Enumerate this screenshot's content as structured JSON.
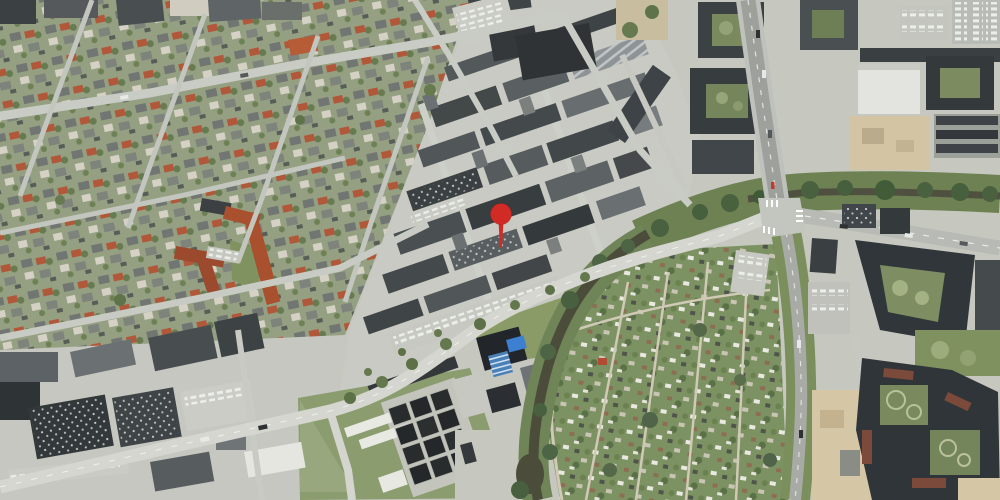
{
  "map": {
    "view": "aerial-satellite-photo",
    "width": 1000,
    "height": 500,
    "marker": {
      "x": 501,
      "y": 214,
      "tip_y": 247,
      "color": "#d22b26",
      "outline": "#9f1d18",
      "svg_transform": "translate(501,214)"
    },
    "palette": {
      "marker_red": "#d22b26",
      "canvas": "#c6c8c0",
      "road_light": "#d5d6d0",
      "asphalt": "#a8aba5",
      "water": "#4c4c3a",
      "greenery": "#7d9263",
      "industrial_roof": "#44494c",
      "red_tile_roof": "#a9502f",
      "construction_sand": "#d5c7a5",
      "solar_blue": "#3d7fd0"
    },
    "features": {
      "northwest": "residential-neighborhood",
      "north-center": "commercial-industrial-strip",
      "center": "business-park-with-marker",
      "southwest": "warehouse-district",
      "south-center": "utility-facility-basins",
      "southeast": "allotment-gardens",
      "east": "apartment-blocks-and-construction",
      "waterway": "stream-corridor",
      "junction": "major-signalized-intersection"
    }
  }
}
